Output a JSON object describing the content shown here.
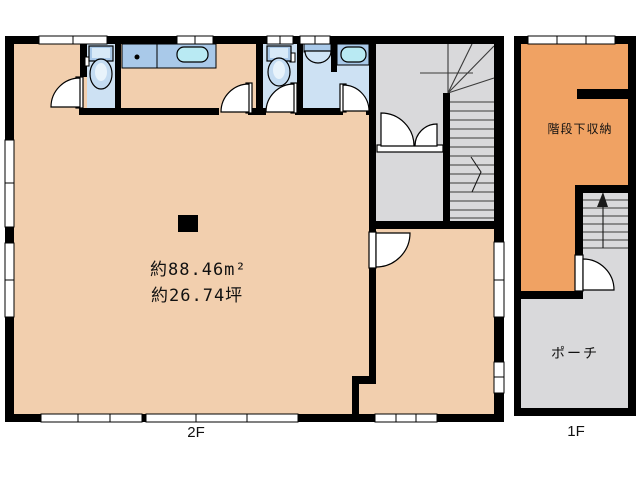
{
  "plans": {
    "floor_2": {
      "label": "2F",
      "area_text_1": "約88.46m²",
      "area_text_2": "約26.74坪"
    },
    "floor_1": {
      "label": "1F",
      "storage_label": "階段下収納",
      "porch_label": "ポーチ"
    }
  },
  "palette": {
    "floor_peach": "#f2cfae",
    "storage_orange": "#f0a263",
    "hall_gray": "#d9d9db",
    "wet_room_blue": "#cde1f3",
    "fixture_blue": "#a9c9e9",
    "tub_cyan": "#b9eaf3",
    "wall_black": "#000000",
    "background": "#ffffff"
  }
}
